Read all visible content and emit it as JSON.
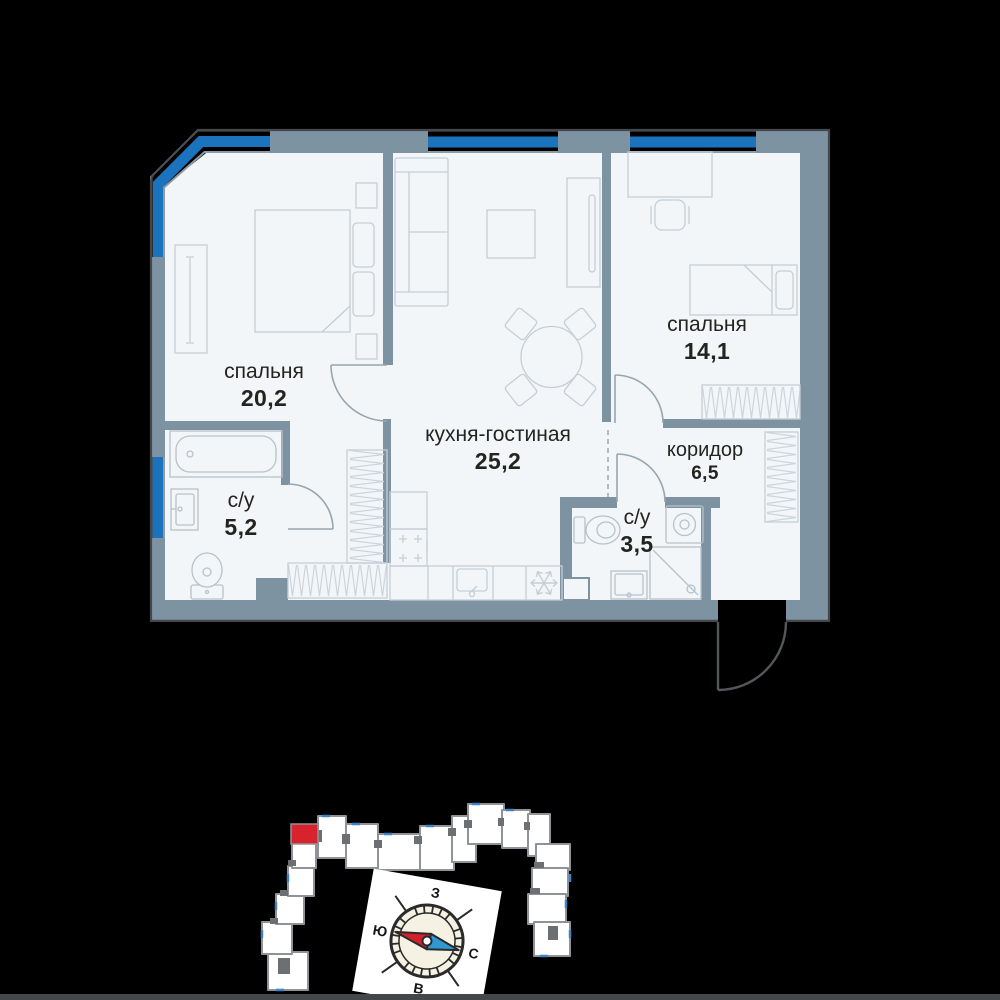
{
  "floor_plan": {
    "rooms": [
      {
        "id": "bedroom-1",
        "name": "спальня",
        "area": "20,2"
      },
      {
        "id": "kitchen-living",
        "name": "кухня-гостиная",
        "area": "25,2"
      },
      {
        "id": "bedroom-2",
        "name": "спальня",
        "area": "14,1"
      },
      {
        "id": "corridor",
        "name": "коридор",
        "area": "6,5"
      },
      {
        "id": "bathroom-1",
        "name": "с/у",
        "area": "5,2"
      },
      {
        "id": "bathroom-2",
        "name": "с/у",
        "area": "3,5"
      }
    ],
    "colors": {
      "wall": "#7d93a1",
      "window_glass": "#1a73bc",
      "floor": "#f2f6f9",
      "furniture_line": "#c5ced6",
      "door_line": "#98a5ae",
      "entrance_door_line": "#53575a",
      "label_text": "#24241f"
    }
  },
  "site_plan": {
    "highlight_color": "#d8232f",
    "building_fill": "#ffffff",
    "building_outline": "#8f9397",
    "compass": {
      "west": "З",
      "south": "Ю",
      "north": "С",
      "east": "В"
    }
  }
}
